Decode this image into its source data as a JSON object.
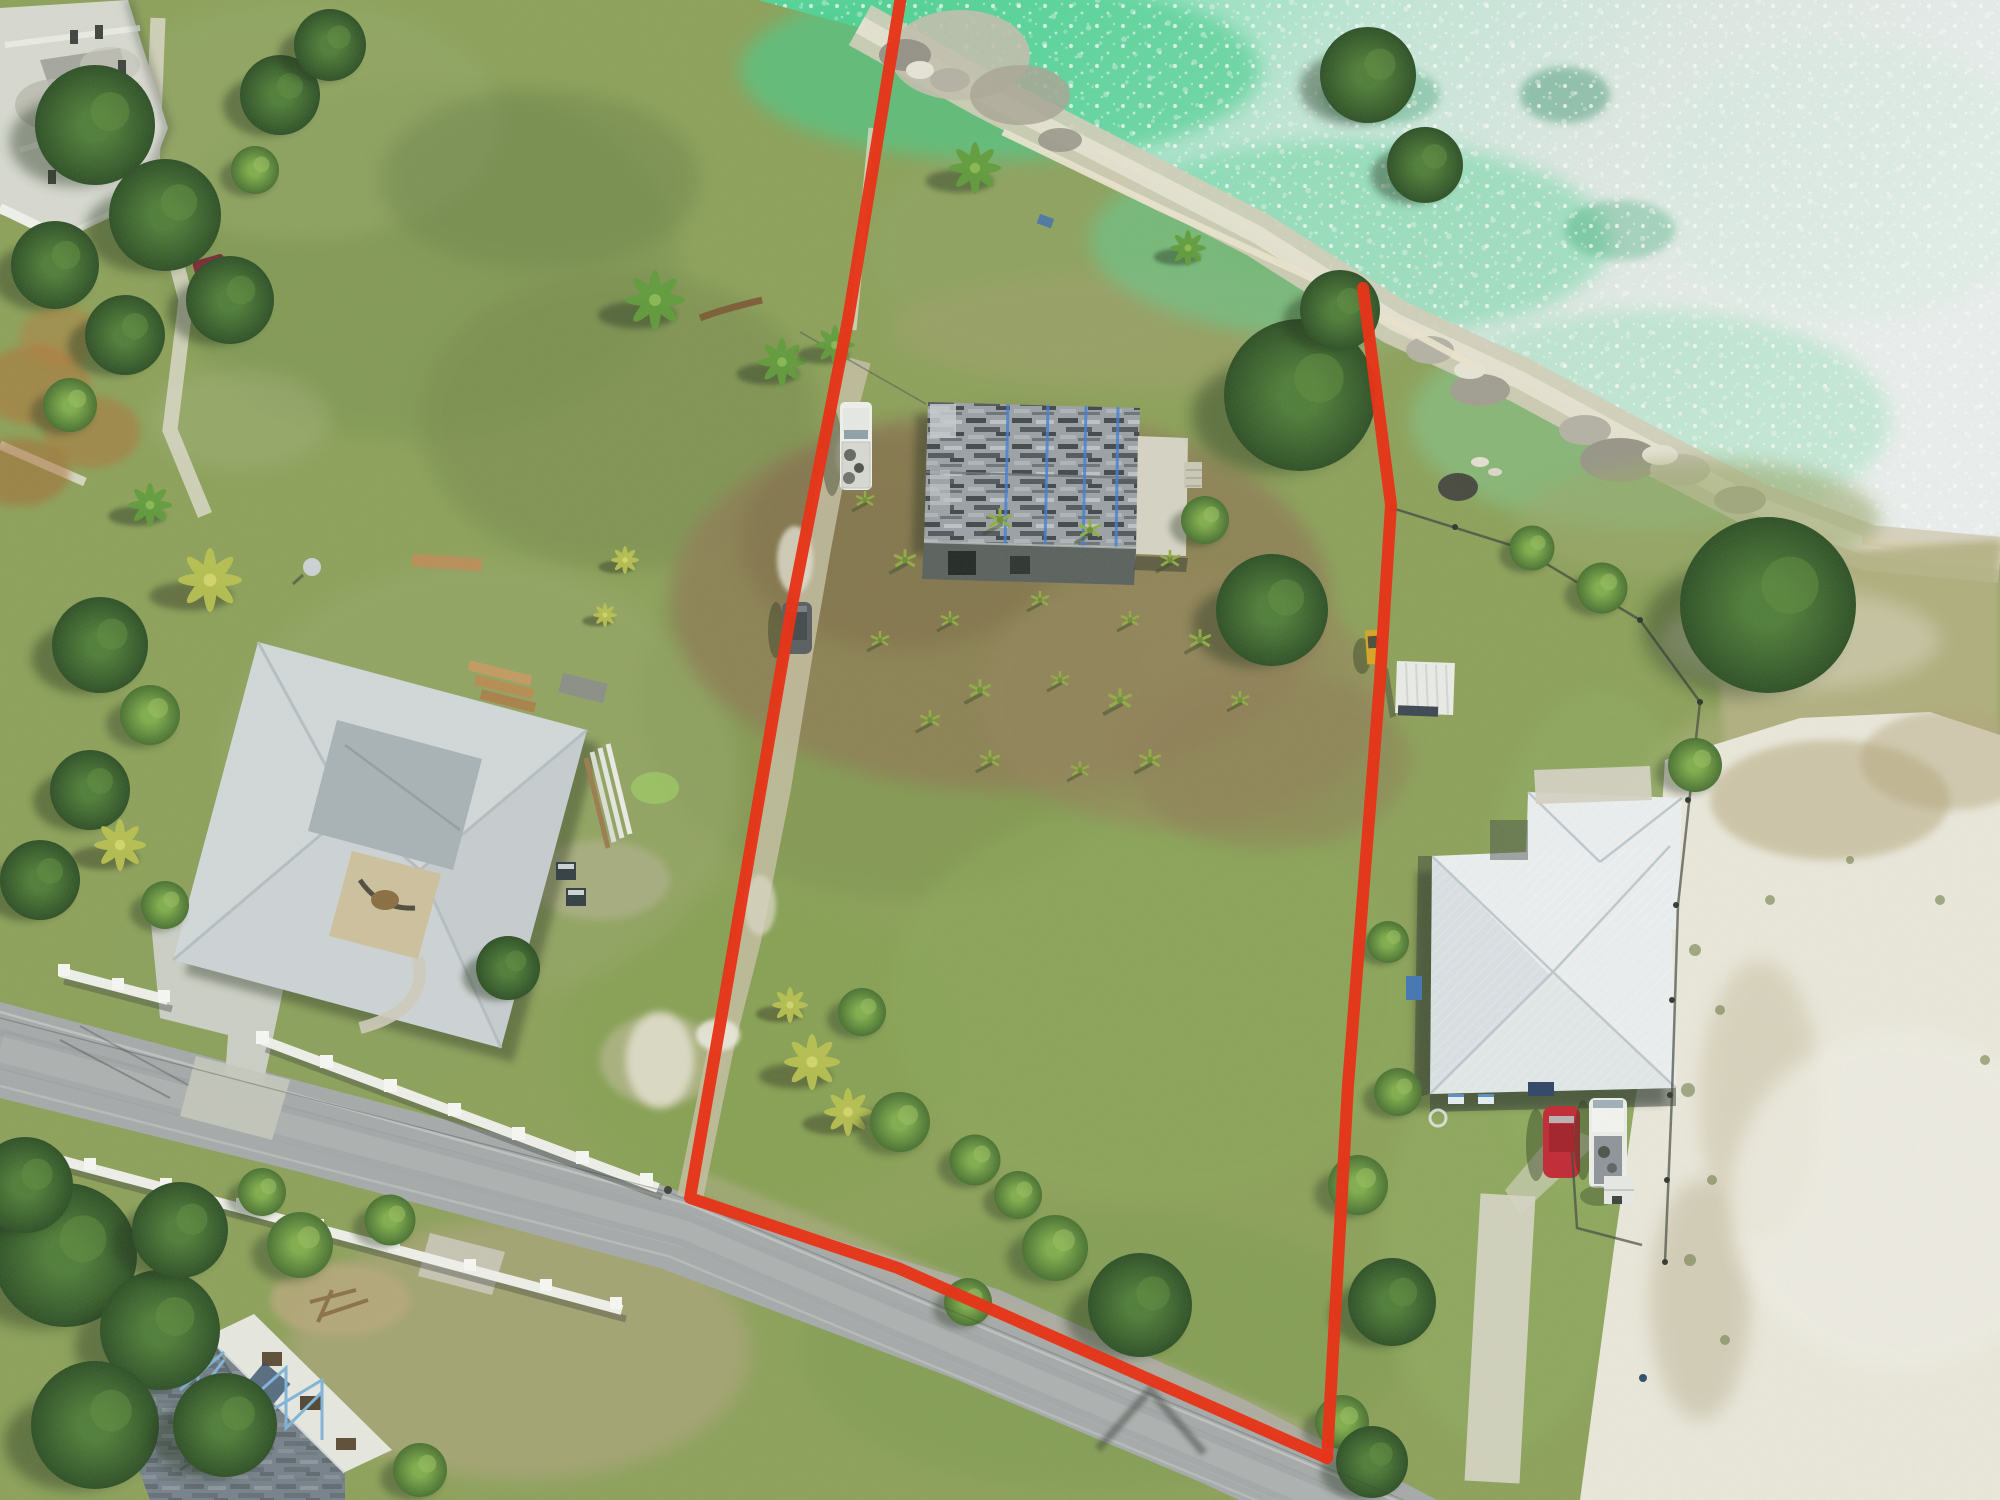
{
  "image": {
    "kind": "aerial-drone-photograph",
    "description": "Overhead real-estate drone photo: vacant beachfront parcel outlined in red, derelict shingle-roof house in parcel, neighboring white-roof houses, coastal road below, turquoise sparkling sea above",
    "width_px": 2000,
    "height_px": 1500
  },
  "palette": {
    "boundary_red": "#ea2a0d",
    "water_shallow": "#4ed395",
    "water_far": "#edf1f0",
    "shore_rock": "#d5cfba",
    "seawall": "#ece5d0",
    "grass_base": "#8ca158",
    "grass_dark": "#6d8449",
    "grass_dry": "#b4b182",
    "dirt_orchard": "#8d7c52",
    "sand_white": "#eceadd",
    "road_asphalt": "#a6aaab",
    "wall_white": "#f1f2ec",
    "concrete": "#cdd0c6",
    "roof_derelict": "#9ba1a5",
    "tarp_blue": "#3e7ed8",
    "roof_left_house": "#d4d9db",
    "roof_right_house": "#eef1f2",
    "roof_construction": "#75808a",
    "truss_blue": "#7fb4da",
    "vehicle_maroon": "#7c2634",
    "vehicle_red": "#c32531",
    "vehicle_white": "#f2f3ef",
    "vehicle_gray": "#565b5f",
    "tree_dark": "#2e5426",
    "tree_light": "#6fa03f",
    "palm_yellow": "#b9c24e",
    "shrub_orange": "#b06f35"
  }
}
